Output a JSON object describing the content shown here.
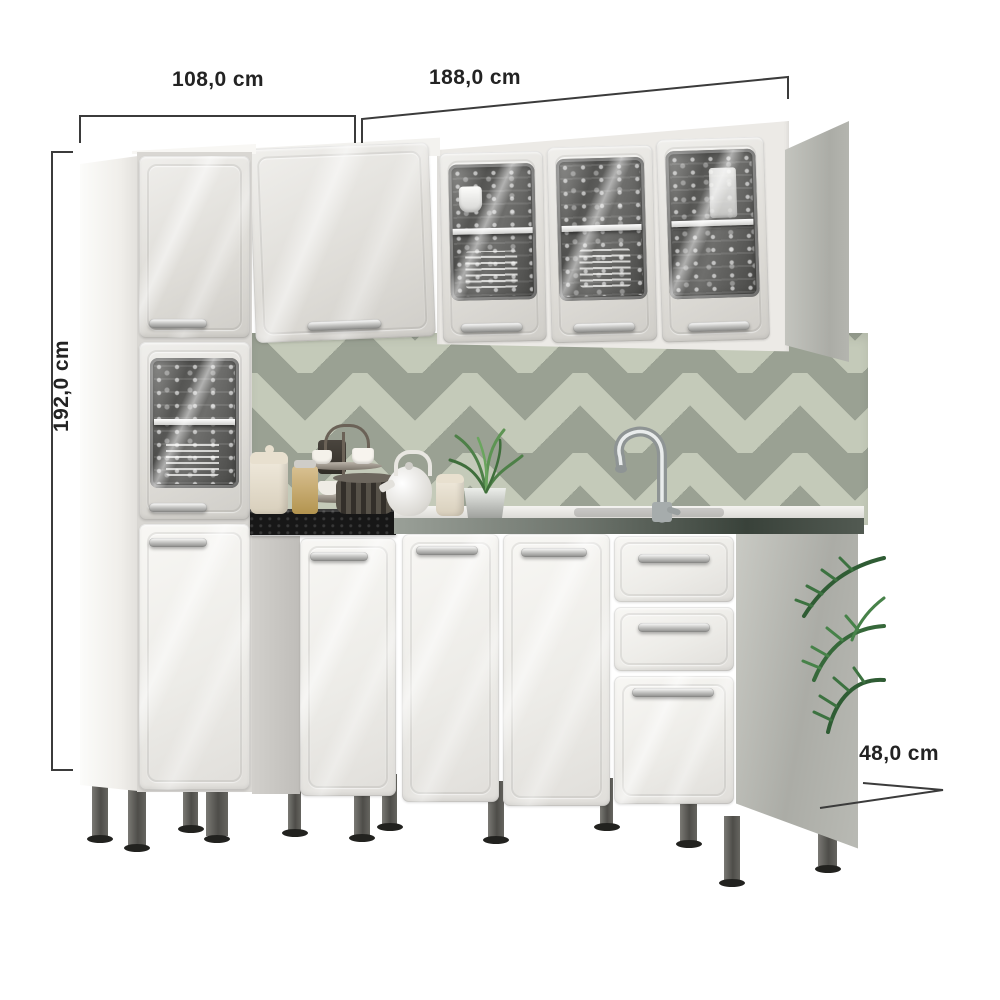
{
  "product": {
    "dimensions": {
      "width_left": "108,0 cm",
      "width_right": "188,0 cm",
      "height": "192,0 cm",
      "depth": "48,0 cm"
    }
  },
  "colors": {
    "background": "#ffffff",
    "dimension_line": "#3b3b3b",
    "label_text": "#232323",
    "cabinet_white": "#f5f4f1",
    "cabinet_gray": "#d9d7d2",
    "side_panel_gray": "#b8b9b3",
    "glass_dark": "#555553",
    "chevron_sage": "#c4cab9",
    "chevron_gray": "#9aa193",
    "counter_black": "#161616",
    "counter_steel": "#6d746c",
    "leg_gray": "#55544f",
    "plant_green": "#3c7240",
    "handle_chrome": "#c9c9c7"
  }
}
